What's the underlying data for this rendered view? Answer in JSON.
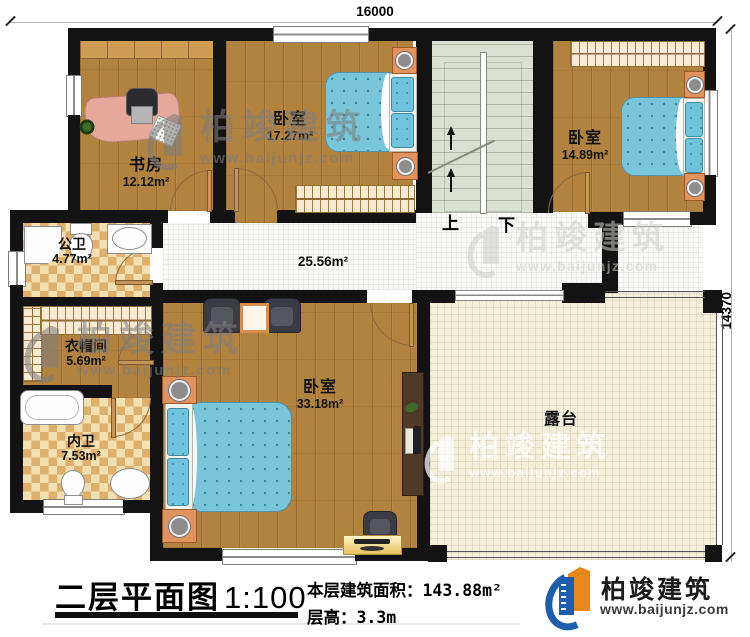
{
  "plan": {
    "dim_top": "16000",
    "dim_right": "14370",
    "hallway_area": "25.56m²",
    "stairs_up": "上",
    "stairs_down": "下",
    "rooms": {
      "study": {
        "name": "书房",
        "area": "12.12m²"
      },
      "bedroom2": {
        "name": "卧室",
        "area": "17.27m²"
      },
      "bedroom3": {
        "name": "卧室",
        "area": "14.89m²"
      },
      "public_bath": {
        "name": "公卫",
        "area": "4.77m²"
      },
      "cloak": {
        "name": "衣帽间",
        "area": "5.69m²"
      },
      "inner_bath": {
        "name": "内卫",
        "area": "7.53m²"
      },
      "master": {
        "name": "卧室",
        "area": "33.18m²"
      },
      "terrace": {
        "name": "露台"
      }
    }
  },
  "footer": {
    "title": "二层平面图",
    "scale": "1:100",
    "area_label": "本层建筑面积：",
    "area_value": "143.88m²",
    "floor_height_label": "层高：",
    "floor_height_value": "3.3m"
  },
  "brand": {
    "name": "柏竣建筑",
    "url": "www.baijunjz.com"
  },
  "watermark": {
    "name": "柏竣建筑",
    "url": "www.baijunjz.com"
  },
  "colors": {
    "wall": "#131313",
    "wood": "#b2823f",
    "bed_blue": "#79c6da",
    "checker_tan": "#dfb06c",
    "terrace_cream": "#f3efdb",
    "brand_blue": "#1d5fae",
    "brand_orange": "#e8871d"
  }
}
